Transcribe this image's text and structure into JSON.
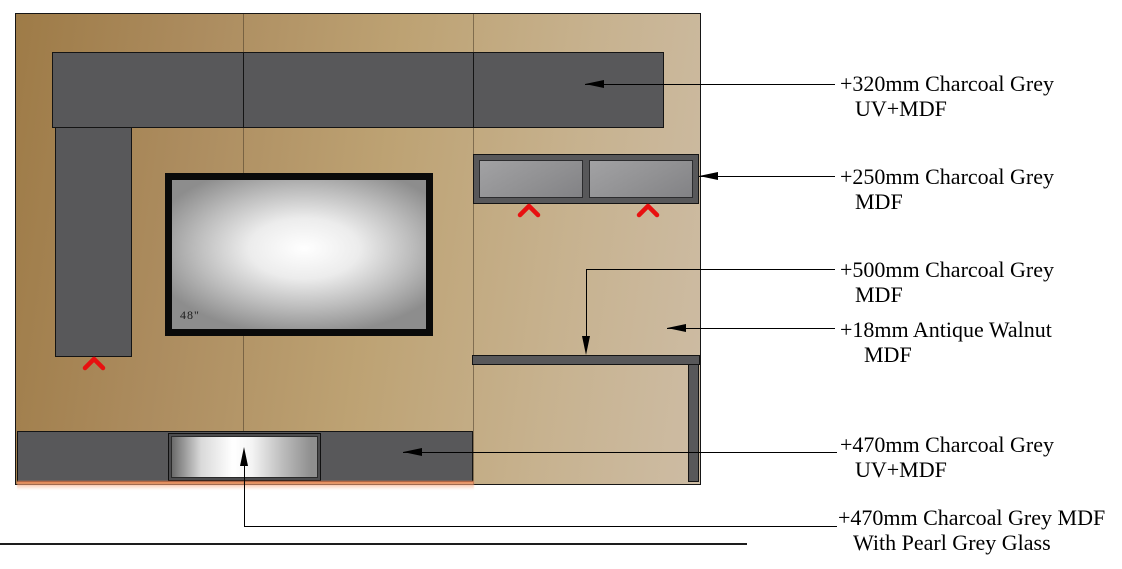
{
  "tv": {
    "size_label": "48\""
  },
  "annotations": [
    {
      "line1": "+320mm Charcoal Grey",
      "line2": "UV+MDF"
    },
    {
      "line1": "+250mm Charcoal Grey",
      "line2": "MDF"
    },
    {
      "line1": "+500mm Charcoal Grey",
      "line2": "MDF"
    },
    {
      "line1": "+18mm Antique Walnut",
      "line2": "MDF"
    },
    {
      "line1": "+470mm Charcoal Grey",
      "line2": "UV+MDF"
    },
    {
      "line1": "+470mm Charcoal Grey MDF",
      "line2": "With Pearl Grey Glass"
    }
  ],
  "colors": {
    "charcoal_panel": "#58585a",
    "wall_tan_dark": "#9e7b47",
    "wall_tan_light": "#cdbca4",
    "cabinet_door_grey": "#919193",
    "chevron_red": "#e81010",
    "glow_orange": "#f28654",
    "leader_black": "#000000"
  }
}
